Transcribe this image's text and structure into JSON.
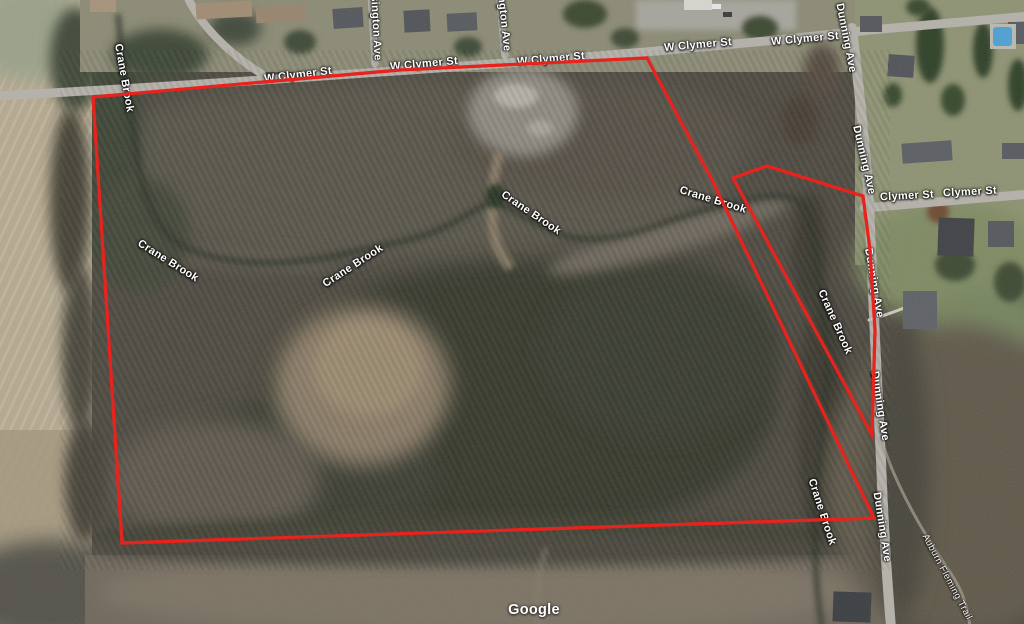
{
  "map": {
    "watermark": "Google",
    "boundary_color": "#e8231d",
    "street_labels": {
      "w_clymer_st": "W Clymer St",
      "clymer_st": "Clymer St",
      "dunning_ave": "Dunning Ave",
      "sington_ave": "sington Ave",
      "ington_ave": "ington Ave"
    },
    "water_labels": {
      "crane_brook": "Crane Brook"
    },
    "trail_labels": {
      "auburn_fleming_trail": "Auburn Fleming Trail"
    }
  }
}
